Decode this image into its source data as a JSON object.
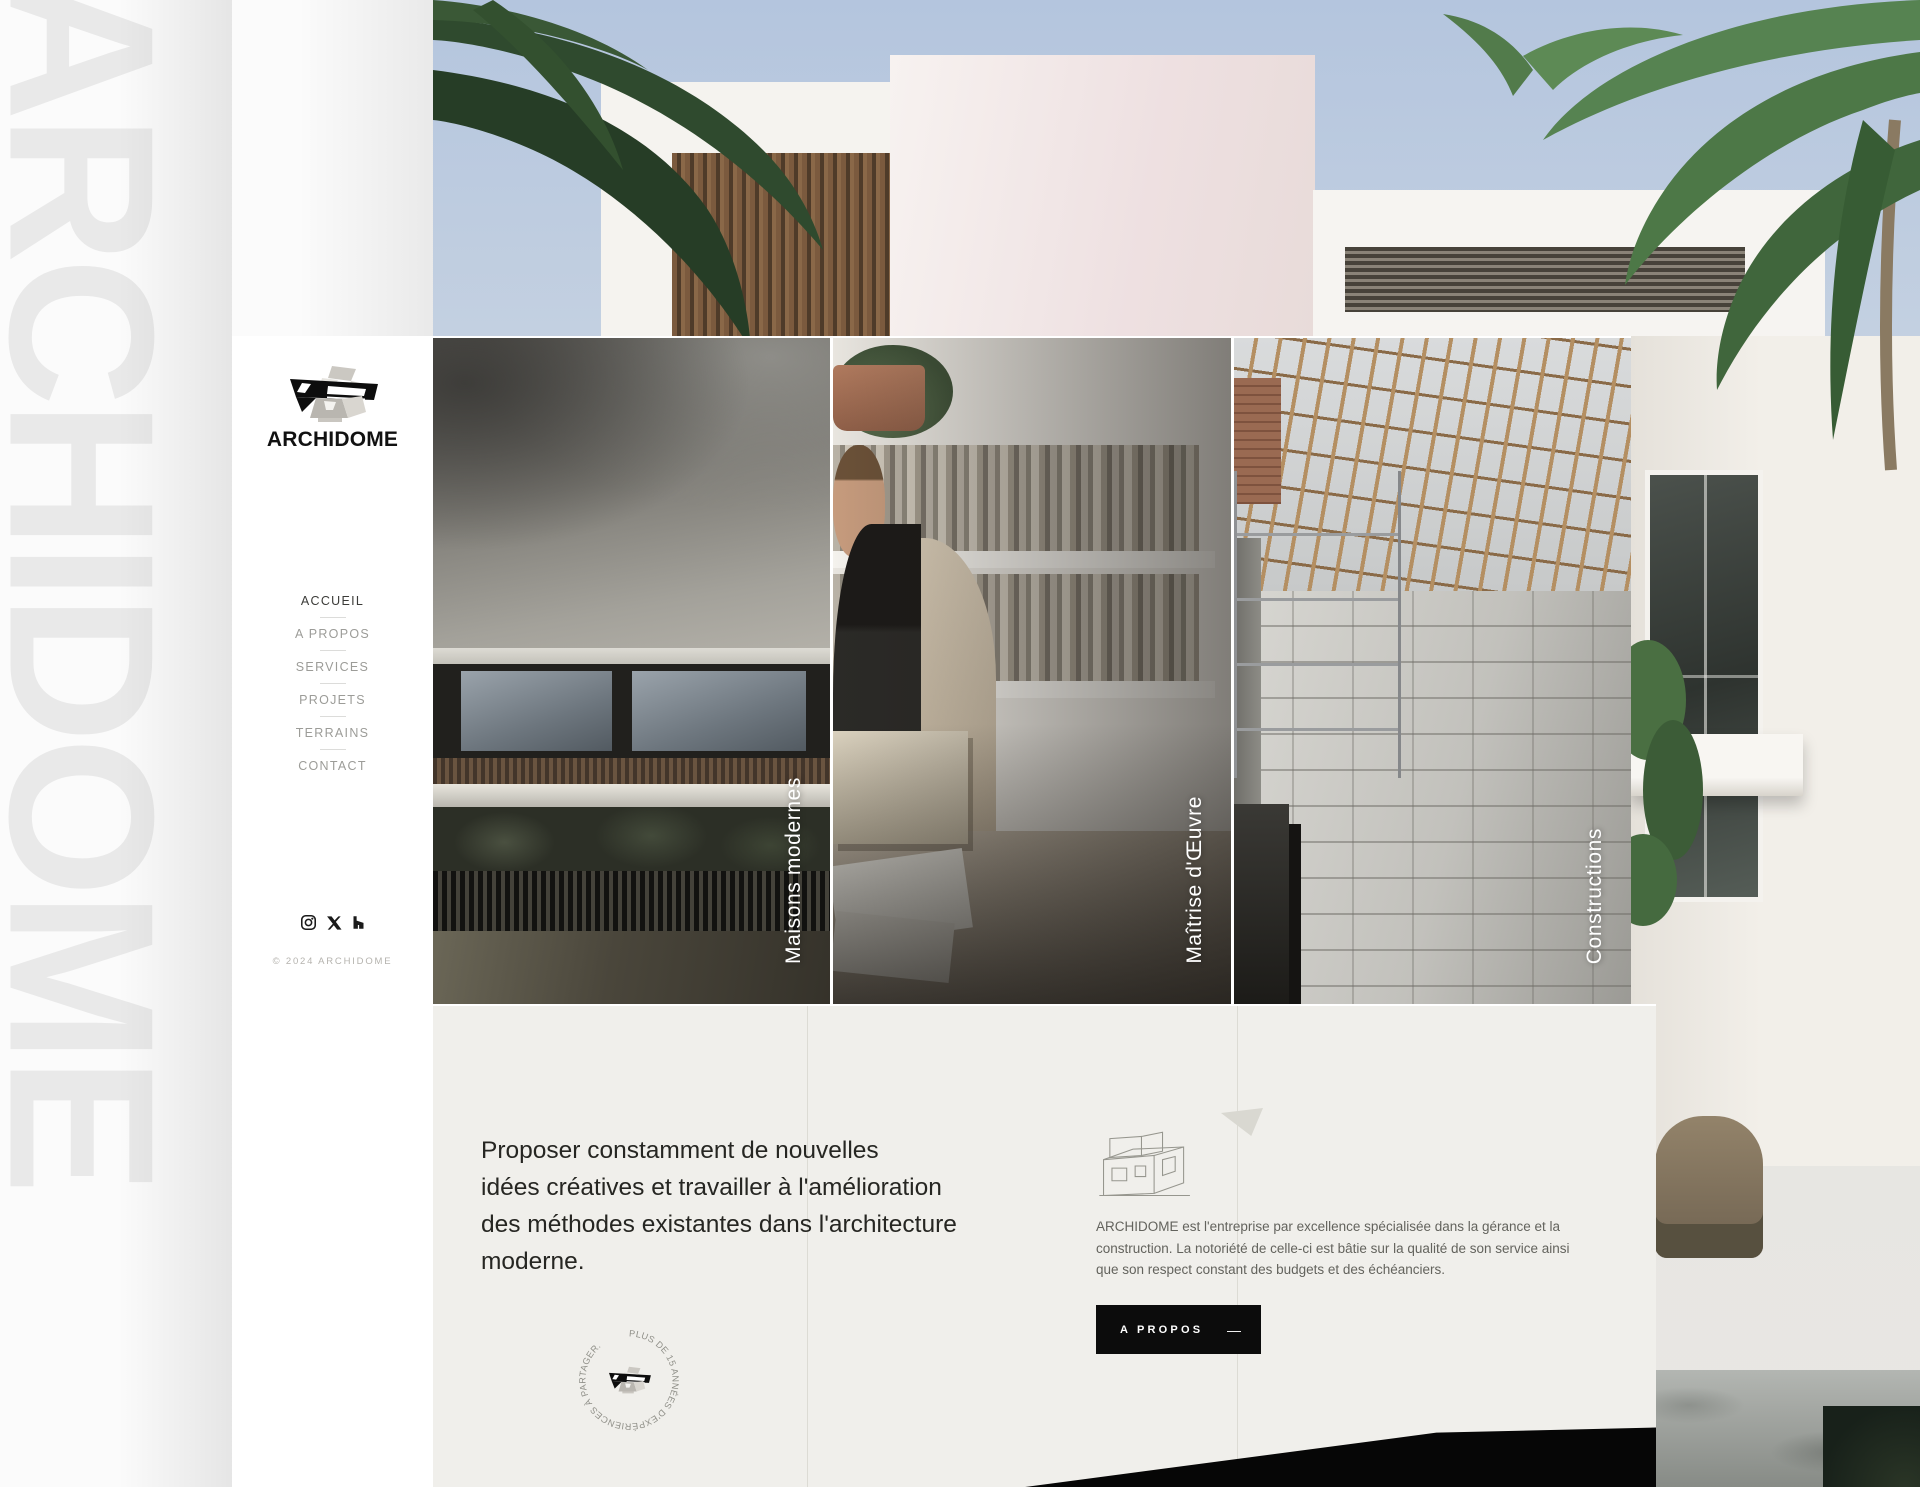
{
  "brand": {
    "name": "ARCHIDOME",
    "watermark": "ARCHIDOME"
  },
  "sidebar": {
    "nav": [
      {
        "label": "ACCUEIL",
        "active": true
      },
      {
        "label": "A PROPOS",
        "active": false
      },
      {
        "label": "SERVICES",
        "active": false
      },
      {
        "label": "PROJETS",
        "active": false
      },
      {
        "label": "TERRAINS",
        "active": false
      },
      {
        "label": "CONTACT",
        "active": false
      }
    ],
    "social": [
      {
        "name": "instagram"
      },
      {
        "name": "x"
      },
      {
        "name": "houzz"
      }
    ],
    "copyright": "© 2024 ARCHIDOME"
  },
  "cards": [
    {
      "label": "Maisons modernes"
    },
    {
      "label": "Maîtrise d'Œuvre"
    },
    {
      "label": "Constructions"
    }
  ],
  "about": {
    "statement_lines": [
      "Proposer constamment de nouvelles",
      "idées créatives et travailler à l'amélioration",
      "des méthodes existantes dans l'architecture",
      "moderne."
    ],
    "description": "ARCHIDOME est l'entreprise par excellence spécialisée dans la gérance et la construction. La notoriété de celle-ci est bâtie sur la qualité de son service ainsi que son respect constant des budgets et des échéanciers.",
    "button_label": "A PROPOS",
    "button_dash": "—",
    "stamp_text": "PLUS DE 15 ANNÉES D'EXPÉRIENCES À PARTAGER."
  },
  "colors": {
    "accent_black": "#0c0c0c",
    "section_bg": "#f0efeb",
    "watermark": "#e9e9e9",
    "card_label": "#ffffff"
  }
}
